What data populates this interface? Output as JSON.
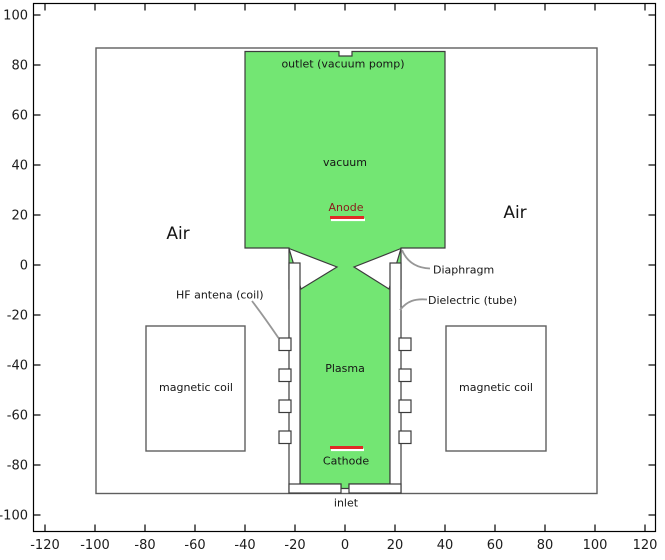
{
  "diagram_title": "plasma-source-model-geometry",
  "labels": {
    "outlet": "outlet (vacuum pomp)",
    "vacuum": "vacuum",
    "anode": "Anode",
    "air_left": "Air",
    "air_right": "Air",
    "diaphragm": "Diaphragm",
    "hf_antenna": "HF antena (coil)",
    "dielectric": "Dielectric (tube)",
    "magnetic_coil_left": "magnetic coil",
    "magnetic_coil_right": "magnetic coil",
    "plasma": "Plasma",
    "cathode": "Cathode",
    "inlet": "inlet"
  },
  "axes": {
    "x_ticks": [
      -120,
      -100,
      -80,
      -60,
      -40,
      -20,
      0,
      20,
      40,
      60,
      80,
      100,
      120
    ],
    "y_ticks": [
      -100,
      -80,
      -60,
      -40,
      -20,
      0,
      20,
      40,
      60,
      80,
      100
    ],
    "x_range": [
      -125,
      125
    ],
    "y_range": [
      -105,
      105
    ]
  },
  "colors": {
    "region_green": "#73e673",
    "electrode_red": "#e12a26",
    "anode_text_maroon": "#8b1a1a",
    "geometry_stroke": "#3c3c3c",
    "outer_box_stroke": "#5f5f5f",
    "leader_gray": "#979797",
    "axis_black": "#000000"
  }
}
